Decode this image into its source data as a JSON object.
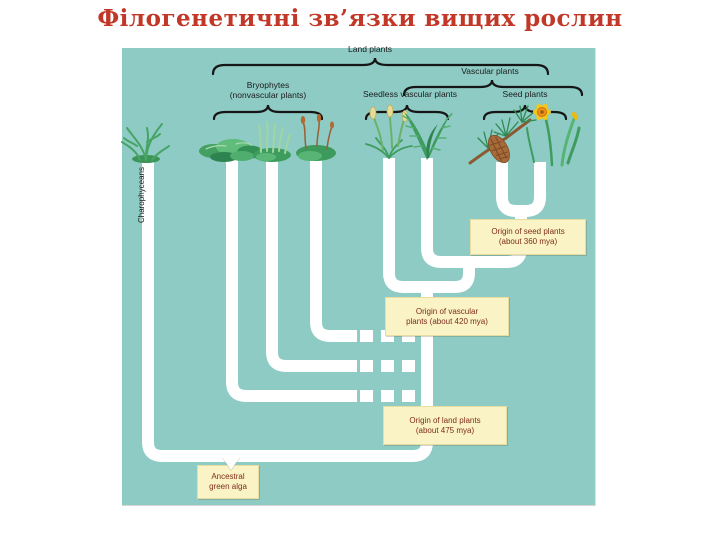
{
  "slide": {
    "title": "Філогенетичні зв’язки вищих рослин"
  },
  "tree": {
    "group_labels": {
      "land_plants": "Land plants",
      "vascular_plants": "Vascular plants",
      "bryophytes_line1": "Bryophytes",
      "bryophytes_line2": "(nonvascular plants)",
      "seedless_vascular_plants": "Seedless vascular plants",
      "seed_plants": "Seed plants",
      "charophyceans": "Charophyceans"
    },
    "taxa_icons": [
      "charophycean-alga-icon",
      "liverwort-icon",
      "hornwort-icon",
      "moss-icon",
      "lycophyte-icon",
      "fern-icon",
      "pine-branch-cone-icon",
      "daffodil-icon"
    ],
    "callouts": {
      "seed_origin": {
        "line1": "Origin of seed plants",
        "line2": "(about 360 mya)"
      },
      "vascular_origin": {
        "line1": "Origin of vascular",
        "line2": "plants (about 420 mya)"
      },
      "land_origin": {
        "line1": "Origin of land plants",
        "line2": "(about 475 mya)"
      },
      "ancestral_alga": {
        "line1": "Ancestral",
        "line2": "green alga"
      }
    }
  },
  "colors": {
    "panel_teal": "#8ecbc4",
    "branch_white": "#ffffff",
    "title_red": "#c13828",
    "callout_yellow": "#faf3c5",
    "callout_text_maroon": "#7e2c1e",
    "label_black": "#1b1b1b"
  }
}
